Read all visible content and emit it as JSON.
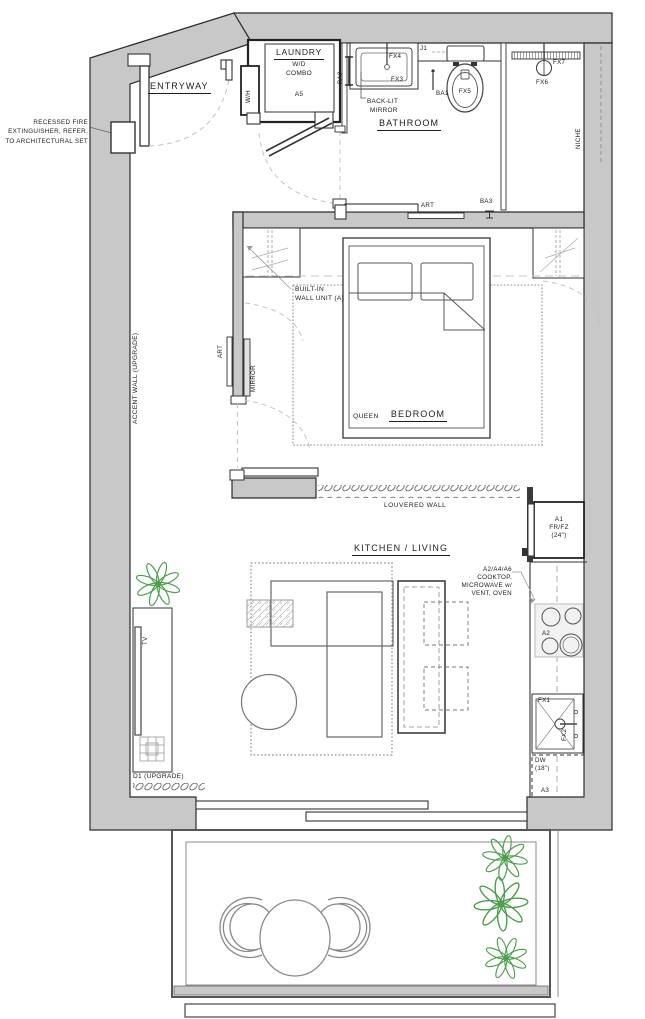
{
  "colors": {
    "wall_fill": "#c8c8c8",
    "line": "#2b2b2b",
    "dash": "#c4c4c4",
    "plant_green": "#4a9e4a"
  },
  "rooms": {
    "entryway": "ENTRYWAY",
    "bathroom": "BATHROOM",
    "bedroom": "BEDROOM",
    "kitchen_living": "KITCHEN / LIVING",
    "laundry": {
      "title": "LAUNDRY",
      "sub1": "W/D",
      "sub2": "COMBO",
      "code": "A5"
    }
  },
  "notes": {
    "fire1": "RECESSED FIRE",
    "fire2": "EXTINGUISHER, REFER.",
    "fire3": "TO ARCHITECTURAL SET",
    "backlit1": "BACK-LIT",
    "backlit2": "MIRROR",
    "builtin1": "BUILT-IN",
    "builtin2": "WALL UNIT (A)",
    "accent_wall": "ACCENT WALL (UPGRADE)",
    "louvered": "LOUVERED WALL",
    "queen": "QUEEN",
    "callout1": "A2/A4/A6",
    "callout2": "COOKTOP,",
    "callout3": "MICROWAVE w/",
    "callout4": "VENT, OVEN",
    "d1": "D1 (UPGRADE)"
  },
  "tags": {
    "wh": "W/H",
    "ba1": "BA1",
    "ba2": "BA2",
    "ba3": "BA3",
    "j1": "J1",
    "fx1": "FX1",
    "fx2": "FX2",
    "fx3": "FX3",
    "fx4": "FX4",
    "fx5": "FX5",
    "fx6": "FX6",
    "fx7": "FX7",
    "niche": "NICHE",
    "art_top": "ART",
    "art_side": "ART",
    "mirror": "MIRROR",
    "tv": "TV",
    "a1": "A1",
    "a1_type": "FR/FZ",
    "a1_size": "(24\")",
    "a2": "A2",
    "a3": "A3",
    "dw": "DW",
    "dw_size": "(18\")"
  }
}
